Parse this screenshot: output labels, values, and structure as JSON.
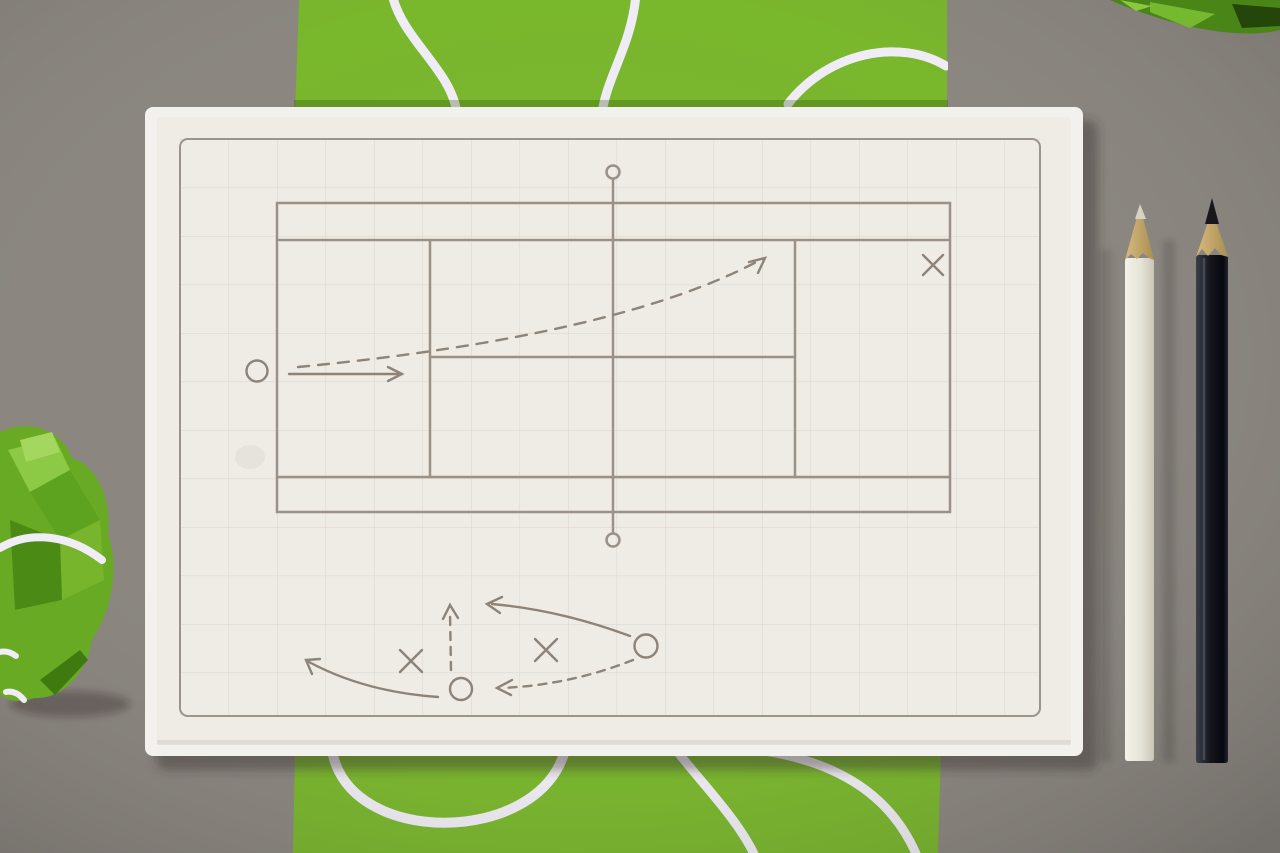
{
  "scene": {
    "description": "Top-down photo of a tennis-strategy notepad on a grey desk: cream grid paper printed with a tennis court diagram, hand-drawn play marks (Xs, Os, arrows), lying on a green wrapping-paper strip with white tennis-ball seam curves; a white pencil and a black pencil on the right, a crumpled green paper ball lower-left and a green paper scrap upper-right",
    "background_label": "grey desk surface",
    "wrap_label": "green wrapping paper strip with white seam pattern",
    "pad_label": "tennis strategy notepad",
    "paper_label": "cream grid paper",
    "court_label": "printed tennis court diagram",
    "plan_court_label": "hand-drawn rally plan on court",
    "plan_sketch_label": "hand-drawn play sketch below court",
    "white_pencil_label": "white pencil",
    "black_pencil_label": "black pencil",
    "ball_label": "crumpled green paper ball",
    "corner_label": "green paper scrap (top right corner)"
  },
  "diagram_marks": {
    "court_area": [
      {
        "mark": "O",
        "desc": "player circle outside left baseline"
      },
      {
        "mark": "solid-arrow",
        "desc": "short straight arrow pointing right from O"
      },
      {
        "mark": "dashed-arrow",
        "desc": "long rising dashed shot arc across the net to the right service box"
      },
      {
        "mark": "X",
        "desc": "opponent mark near right baseline corner"
      }
    ],
    "sketch_area": [
      {
        "mark": "dashed-arrow",
        "desc": "short dashed arrow pointing up"
      },
      {
        "mark": "X",
        "desc": "left opponent mark"
      },
      {
        "mark": "O",
        "desc": "lower-center player circle"
      },
      {
        "mark": "X",
        "desc": "center opponent mark"
      },
      {
        "mark": "O",
        "desc": "right player circle"
      },
      {
        "mark": "solid-arrow",
        "desc": "long arrow from right O toward upper left"
      },
      {
        "mark": "dashed-arrow",
        "desc": "dashed pass curve from right O to lower-center O"
      },
      {
        "mark": "solid-arrow",
        "desc": "curved arrow from lower-center O sweeping left"
      }
    ]
  },
  "colors": {
    "bg": "#8b8680",
    "wrap_green": "#79b72c",
    "wrap_green_shade": "#568f1c",
    "seam_white": "#f1edf6",
    "pad_edge": "#f3f1ed",
    "paper": "#efece6",
    "grid_line": "#ddd8d0",
    "frame_line": "#9c9389",
    "court_line": "#9b9186",
    "ink": "#8e8377",
    "wood_light": "#d8b97e",
    "wood_dark": "#a98f52",
    "pencil_white_1": "#f4f2ea",
    "pencil_white_2": "#c9c6b8",
    "pencil_black_1": "#3a3f4a",
    "pencil_black_2": "#070810",
    "lead_white": "#d6d2c4",
    "lead_black": "#17171c",
    "ball_green_bright": "#8cc944",
    "ball_green_mid": "#69aa24",
    "ball_green_dark": "#3f7a10"
  }
}
